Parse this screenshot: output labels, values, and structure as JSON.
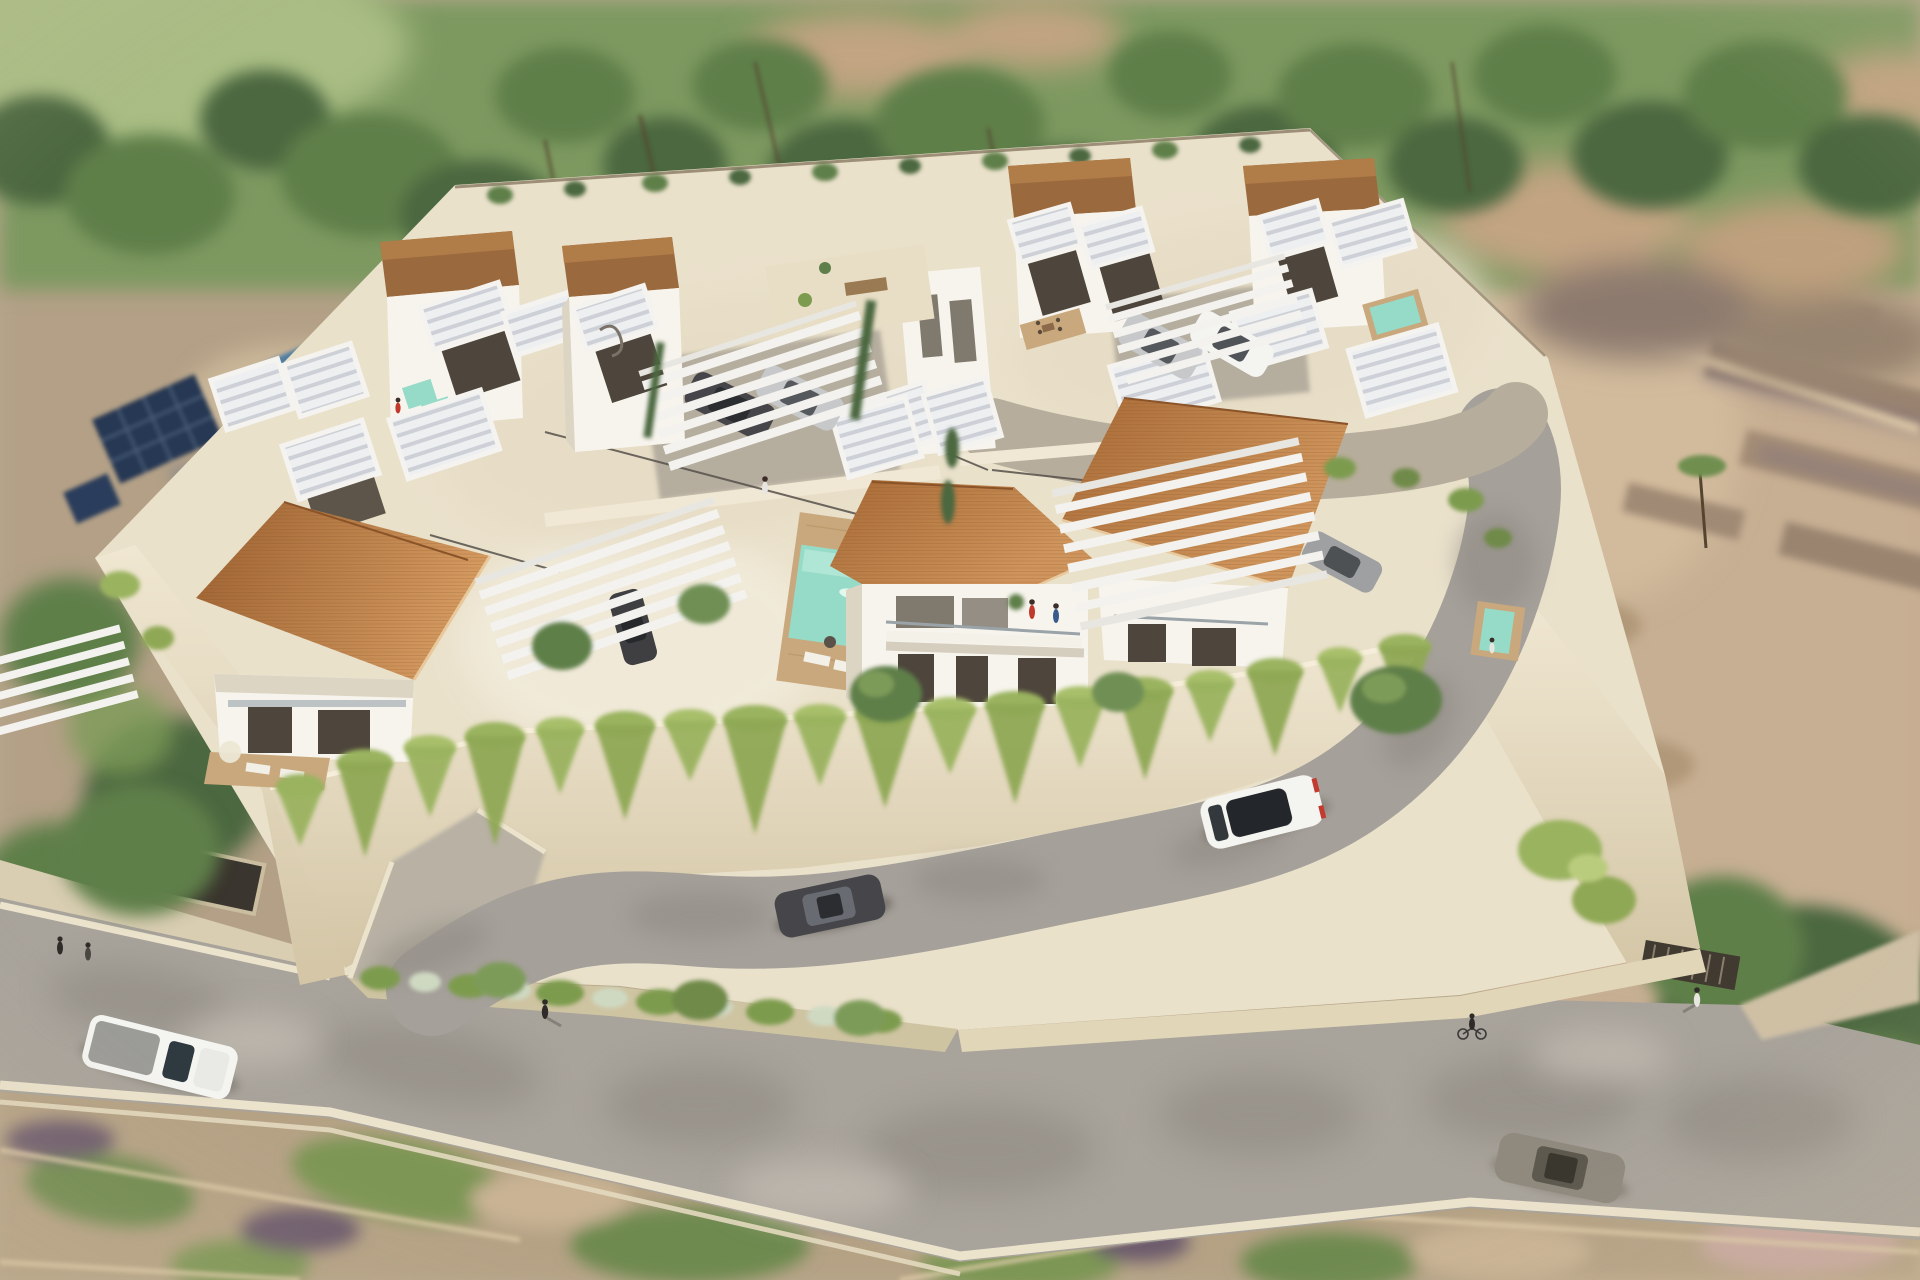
{
  "image": {
    "kind": "3d-architectural-rendering",
    "view": "aerial oblique bird's-eye",
    "subject": "gated residential development of modern white villas with terracotta roofs, private pools, pergolas and perimeter road",
    "style": "photorealistic render, depth-of-field blur on surrounding terrain",
    "width_px": 1920,
    "height_px": 1280
  },
  "palette": {
    "canvas_tan": "#b7a88d",
    "field_green_light": "#a9bd84",
    "veg_band_green": "#7d9960",
    "tree_dark": "#4c683f",
    "tree_mid": "#5f7f4a",
    "tree_light": "#7d9b58",
    "ground_tan": "#c2a482",
    "trunk_brown": "#55452f",
    "neighbor_ground": "#b3a086",
    "neighbor_pool_blue": "#4e7ca3",
    "solar_panel_navy": "#263752",
    "right_terrain_tan": "#c7af93",
    "ruin_stone": "#a08a75",
    "ruin_shadow": "#7d6d7d",
    "platform_cream": "#eae1cb",
    "wall_face_cream": "#e6dac0",
    "villa_white": "#f7f4ed",
    "villa_face_shadow": "#ddd5c4",
    "parapet_roof_brown": "#9a6a3e",
    "roof_terracotta": "#aa6c3a",
    "roof_terracotta_light": "#d0985f",
    "slat_white": "#edeff1",
    "slat_line_gray": "#cdd0d6",
    "glass_dark": "#4e463c",
    "pool_turquoise": "#96dbc8",
    "deck_wood_tan": "#c8a87c",
    "internal_road_gray": "#a5a09a",
    "public_road_gray": "#a8a39b",
    "road_cloud_shadow": "#8d8880",
    "curb_cream": "#ece3cd",
    "sidewalk_cream": "#d9cdb2",
    "vine_green": "#9ab35e",
    "vine_green_light": "#b9cc7d",
    "shrub_green": "#7d9b4e",
    "flower_silver": "#cfd9c2",
    "fence_dark": "#55504a",
    "car_white": "#f4f4f1",
    "car_silver": "#c7c8ca",
    "car_dark_gray": "#46464a",
    "car_taupe": "#8f897e"
  },
  "objects": {
    "villa_clusters": [
      {
        "name": "back-left-cluster",
        "villas": 2,
        "features": [
          "flat brown parapet roofs",
          "white slatted balcony boxes",
          "carport pergola with two cars",
          "spiral stair",
          "plunge pool"
        ]
      },
      {
        "name": "back-right-cluster",
        "villas": 2,
        "features": [
          "flat brown parapet roofs",
          "slatted balcony boxes",
          "carport pergola with two cars",
          "roof terrace dining set",
          "plunge pool"
        ]
      },
      {
        "name": "front-row",
        "villas": 3,
        "features": [
          "pitched terracotta tile roofs",
          "glass balconies",
          "wood deck with loungers",
          "turquoise pools"
        ]
      }
    ],
    "pools": [
      {
        "name": "center-villa-pool",
        "color": "turquoise",
        "deck": "wood",
        "occupant": "swimmer"
      },
      {
        "name": "front-right-plunge-pool",
        "color": "turquoise"
      },
      {
        "name": "back-right-plunge-pool",
        "color": "turquoise"
      },
      {
        "name": "back-left-plunge-pool",
        "color": "turquoise"
      },
      {
        "name": "neighbor-lagoon-pool",
        "color": "blue",
        "location": "adjacent lot west"
      }
    ],
    "vehicles": [
      {
        "name": "white-suv",
        "location": "internal road front",
        "detail": "black panoramic roof, red taillights"
      },
      {
        "name": "dark-hatchback",
        "location": "internal road lower left"
      },
      {
        "name": "dark-sedan",
        "location": "back-left carport"
      },
      {
        "name": "silver-sedan",
        "location": "back-left carport"
      },
      {
        "name": "silver-sedan-2",
        "location": "back-right carport"
      },
      {
        "name": "white-sedan",
        "location": "back-right carport"
      },
      {
        "name": "gray-car",
        "location": "beside front-right villa"
      },
      {
        "name": "dark-car-under-pergola",
        "location": "central courtyard pergola"
      },
      {
        "name": "white-pickup",
        "location": "public road west"
      },
      {
        "name": "taupe-car",
        "location": "public road east"
      }
    ],
    "people": [
      {
        "name": "swimmer",
        "location": "center villa pool"
      },
      {
        "name": "couple-on-balcony",
        "location": "center villa balcony"
      },
      {
        "name": "courtyard-walker",
        "location": "between clusters"
      },
      {
        "name": "road-pedestrian-center",
        "location": "public road"
      },
      {
        "name": "road-pedestrian-east",
        "location": "near east gate"
      },
      {
        "name": "cyclist",
        "location": "public road east"
      },
      {
        "name": "pedestrians-west",
        "location": "public road west"
      }
    ],
    "infrastructure": [
      "perimeter retaining walls with cascading vines",
      "entrance ramp west",
      "dark garage gate west",
      "slatted entrance gate east",
      "curved internal asphalt road",
      "flowering hedge strip along public road",
      "public road with cream curbs"
    ],
    "vegetation": [
      "blurred tree canopy band at top",
      "palm trunks",
      "olive green field top-left",
      "ruins and scrub terrain right",
      "large round tree bottom-right",
      "cypress hedges",
      "round patio trees",
      "vine curtains on walls"
    ]
  }
}
